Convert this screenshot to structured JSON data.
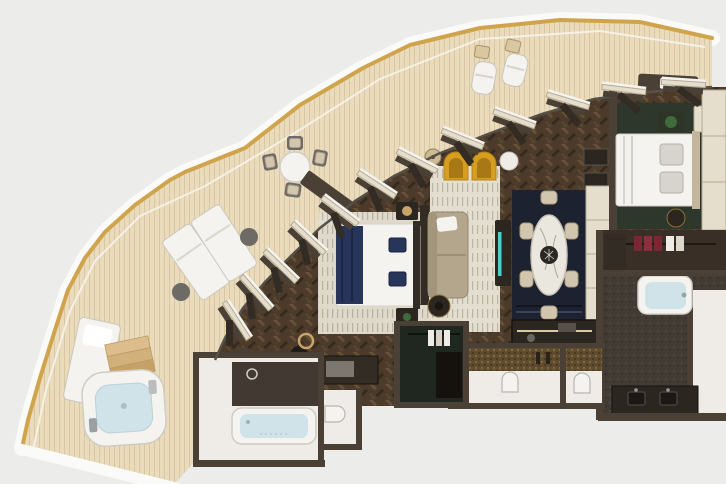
{
  "scene": {
    "description": "Top-down 3D render of a luxury suite floor plan with a curved wrap-around teak terrace, whirlpool, living and dining areas, two bedrooms and three bathrooms",
    "render_type": "floorplan-3d-render",
    "visible_text": ""
  },
  "colors": {
    "bg": "#ececeb",
    "hullWhite": "#fafaf8",
    "gold": "#cfa44c",
    "deck": "#e9dbbb",
    "deckLine": "#d9c7a1",
    "floor": "#4c3b2a",
    "floorLight": "#6d5539",
    "floorDark": "#362a1d",
    "wall": "#4a4036",
    "wallDark": "#332c24",
    "panelBeige": "#e5decd",
    "panelLine": "#b5aa92",
    "rugCream": "#e3decf",
    "rugStripe": "#bcb4a3",
    "rugNavy": "#1d2230",
    "rugGreen": "#2e372b",
    "closetGreen": "#1f2720",
    "white": "#f4f3f0",
    "offWhite": "#efece7",
    "softGray": "#d7d4cd",
    "sofa": "#b3a68c",
    "sofaDark": "#a2957c",
    "yellow": "#d79d1e",
    "yellowDark": "#a87716",
    "navy": "#28355a",
    "navyDark": "#1d2742",
    "marble": "#eae7df",
    "chairCream": "#d2c7ae",
    "chairLine": "#a99e84",
    "water": "#cfe3e9",
    "stone": "#413b34",
    "stoneDot": "#554d42",
    "mosaic": "#5f4c2e",
    "mosaicDot": "#8d7342",
    "woodStep": "#dcbd8b",
    "teal": "#4ed9d6",
    "plant": "#3f6b3a",
    "red": "#7c2633",
    "brass": "#c9a368",
    "charcoal": "#2b2620",
    "gray": "#6e6a66"
  },
  "terrace": {
    "name": "wrap-around terrace",
    "items": [
      "outdoor-dining-table",
      "outdoor-dining-chairs-x4",
      "lounge-chairs-x2",
      "wicker-side-tables-x2",
      "sun-beds-x2",
      "round-side-tables-x2",
      "whirlpool-tub",
      "teak-steps",
      "outdoor-daybed",
      "terrace-bench"
    ]
  },
  "rooms": {
    "living_room": {
      "name": "living room",
      "furniture": [
        "sofa",
        "accent-armchairs-yellow-x2",
        "striped-area-rug",
        "floor-lamp",
        "round-side-table",
        "coffee-table",
        "console-table",
        "wall-shelves"
      ]
    },
    "bedroom_1": {
      "name": "bedroom 1",
      "furniture": [
        "double-bed-navy-throw",
        "nightstands-x2",
        "striped-rug",
        "writing-desk",
        "desk-chair",
        "round-mirror",
        "tv-partition"
      ]
    },
    "dining_area": {
      "name": "dining area",
      "furniture": [
        "oval-marble-table",
        "dining-chairs-x6",
        "navy-rug",
        "sideboard-teal-accent",
        "wardrobe-panel-wall"
      ]
    },
    "kitchenette": {
      "name": "pantry / kitchenette",
      "furniture": [
        "counter",
        "under-counter-light",
        "sink",
        "appliances"
      ]
    },
    "bedroom_2": {
      "name": "bedroom 2",
      "furniture": [
        "double-bed",
        "headboard",
        "gray-pillows-x2",
        "green-area-rug",
        "planter-nightstand",
        "side-cabinet",
        "pouf",
        "closet-cabinets"
      ]
    },
    "walk_in_closet": {
      "name": "walk-in closet",
      "furniture": [
        "hanging-clothes-red",
        "hanging-clothes-white",
        "wardrobe"
      ]
    },
    "master_bathroom": {
      "name": "master bathroom",
      "furniture": [
        "bathtub",
        "double-sink-vanity",
        "stone-floor"
      ]
    },
    "bathroom_1": {
      "name": "bathroom",
      "furniture": [
        "bathtub",
        "rain-shower",
        "vanity-basin",
        "toilet"
      ]
    },
    "water_closets": {
      "name": "guest water closets",
      "furniture": [
        "toilet-a",
        "toilet-b",
        "gold-mosaic-wall",
        "shower-fixture"
      ]
    },
    "wardrobe_room": {
      "name": "wardrobe closet",
      "furniture": [
        "hanging-clothes-white",
        "cabinet"
      ]
    }
  }
}
